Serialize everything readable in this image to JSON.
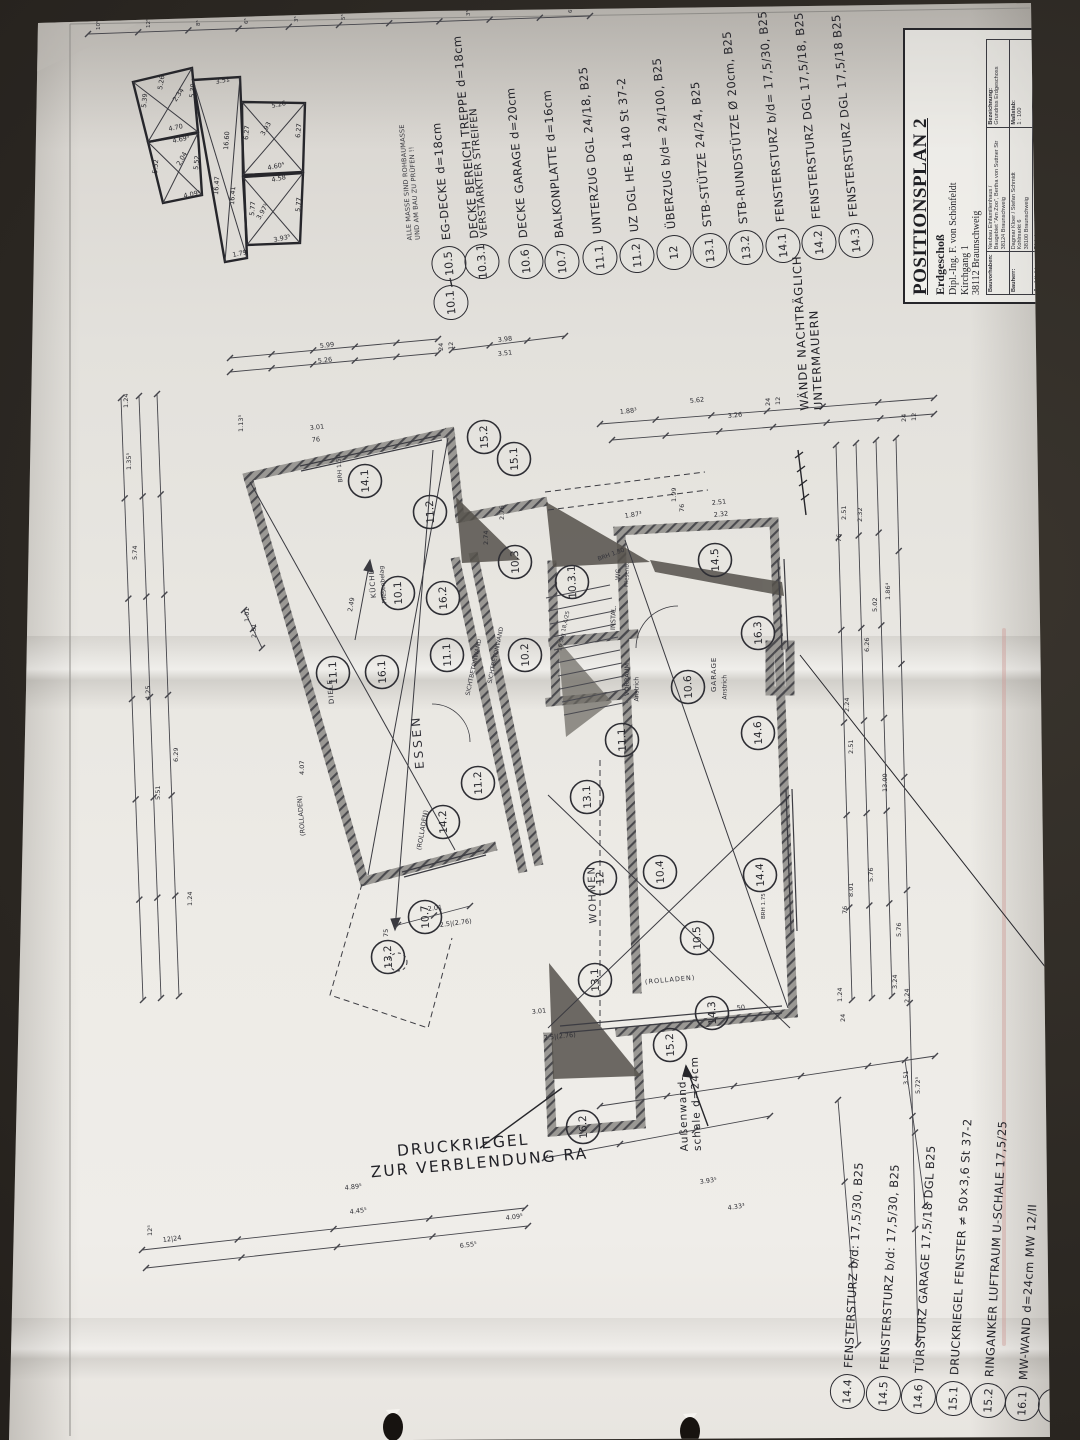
{
  "photo": {
    "background_color": "#2c2823",
    "paper_color": "#e9e7e2",
    "ink_color": "#2e2e34",
    "pencil_color": "#55514b",
    "crease_pink": "#cf9d98"
  },
  "sheet_note": {
    "line1": "ALLE MASSE SIND ROHBAUMASSE",
    "line2": "UND AM BAU ZU PRÜFEN !!"
  },
  "title_block": {
    "title": "POSITIONSPLAN 2",
    "subtitle": "Erdgeschoß",
    "client_line1": "Dipl.-Ing. F. von Schönfeldt",
    "client_line2": "Kirchgang 1",
    "client_line3": "38112 Braunschweig",
    "table": {
      "rows": [
        {
          "label": "Bauvorhaben:",
          "value": "Neubau Einfamilienhaus /\nBaugebiet \"Am Zoo\", Bertha von Suttner Str\n38124 Braunschweig"
        },
        {
          "label": "Bauherr:",
          "value": "Dagmar Kloer / Stefan Schmidt\nKohlmarkt 6\n38100 Braunschweig"
        },
        {
          "label": "Architekt:",
          "value": "Dipl.-Ing. - Architekt AKN Dietrich Bahr\nSpitzwegstraße 14\n38106 Braunschweig"
        }
      ],
      "right_rows": [
        {
          "label": "Bezeichnung:",
          "value": "Grundriss Erdgeschoss"
        },
        {
          "label": "Maßstab:",
          "value": "1 : 100"
        },
        {
          "label": "Zeichn.-Nr./Datum:",
          "value": "0424 - 5/08.08.04 - 0"
        }
      ]
    }
  },
  "legend_top": [
    {
      "id": "10.1",
      "text": ""
    },
    {
      "id": "10.5",
      "text": "EG-DECKE d=18cm"
    },
    {
      "id": "10.3.1",
      "text": "DECKE BEREICH TREPPE d=18cm",
      "text2": "VERSTÄRKTER STREIFEN"
    },
    {
      "id": "10.6",
      "text": "DECKE GARAGE d=20cm"
    },
    {
      "id": "10.7",
      "text": "BALKONPLATTE d=16cm"
    },
    {
      "id": "11.1",
      "text": "UNTERZUG DGL 24/18, B25"
    },
    {
      "id": "11.2",
      "text": "UZ DGL HE-B 140 St 37-2"
    },
    {
      "id": "12",
      "text": "ÜBERZUG b/d= 24/100, B25"
    },
    {
      "id": "13.1",
      "text": "STB-STÜTZE 24/24, B25"
    },
    {
      "id": "13.2",
      "text": "STB-RUNDSTÜTZE Ø 20cm, B25"
    },
    {
      "id": "14.1",
      "text": "FENSTERSTURZ b/d= 17,5/30, B25"
    },
    {
      "id": "14.2",
      "text": "FENSTERSTURZ DGL 17,5/18, B25"
    },
    {
      "id": "14.3",
      "text": "FENSTERSTURZ DGL 17,5/18 B25"
    }
  ],
  "legend_bottom": [
    {
      "id": "14.4",
      "text": "FENSTERSTURZ b/d: 17,5/30, B25"
    },
    {
      "id": "14.5",
      "text": "FENSTERSTURZ b/d: 17,5/30, B25"
    },
    {
      "id": "14.6",
      "text": "TÜRSTURZ GARAGE 17,5/18 DGL B25"
    },
    {
      "id": "15.1",
      "text": "DRUCKRIEGEL FENSTER ≠ 50×3,6 St 37-2"
    },
    {
      "id": "15.2",
      "text": "RINGANKER LUFTRAUM U-SCHALE 17,5/25"
    },
    {
      "id": "16.1",
      "text": "MW-WAND d=24cm   MW 12/II"
    },
    {
      "id": "16.2",
      "text": "STB-WAND d=24cm, B25"
    }
  ],
  "legend_side": {
    "id": "16.3",
    "text": "MW-KAMINWAND d=17,5cm   MW 12/II"
  },
  "plan": {
    "labels": [
      {
        "t": "ESSEN",
        "x": 420,
        "y": 762,
        "r": -95,
        "s": 12,
        "ls": 3
      },
      {
        "t": "WOHNEN",
        "x": 594,
        "y": 918,
        "r": -92,
        "s": 10,
        "ls": 2
      },
      {
        "t": "KÜCHE",
        "x": 374,
        "y": 594,
        "r": -95,
        "s": 7,
        "ls": 1
      },
      {
        "t": "Fliesenbelag",
        "x": 385,
        "y": 600,
        "r": -95,
        "s": 6,
        "ls": 0
      },
      {
        "t": "GARAGE",
        "x": 714,
        "y": 688,
        "r": -90,
        "s": 7,
        "ls": 1
      },
      {
        "t": "Anstrich",
        "x": 725,
        "y": 696,
        "r": -90,
        "s": 6,
        "ls": 0
      },
      {
        "t": "VORRAUM",
        "x": 627,
        "y": 692,
        "r": -90,
        "s": 6.5,
        "ls": 0
      },
      {
        "t": "Anstrich",
        "x": 637,
        "y": 698,
        "r": -90,
        "s": 6,
        "ls": 0
      },
      {
        "t": "WC",
        "x": 618,
        "y": 576,
        "r": -88,
        "s": 6.5,
        "ls": 0
      },
      {
        "t": "Fliesenb.",
        "x": 627,
        "y": 584,
        "r": -88,
        "s": 5.5,
        "ls": 0
      },
      {
        "t": "INSTAL.",
        "x": 613,
        "y": 626,
        "r": -88,
        "s": 6.5,
        "ls": 0
      },
      {
        "t": "DIELE",
        "x": 332,
        "y": 700,
        "r": -95,
        "s": 7,
        "ls": 1
      },
      {
        "t": "(ROLLADEN)",
        "x": 303,
        "y": 832,
        "r": -95,
        "s": 6.5,
        "ls": 0
      },
      {
        "t": "(ROLLADEN)",
        "x": 419,
        "y": 846,
        "r": -80,
        "s": 6.5,
        "ls": 0
      },
      {
        "t": "(ROLLADEN)",
        "x": 645,
        "y": 978,
        "r": -5,
        "s": 6.5,
        "ls": 1
      },
      {
        "t": "SICHTBETONWAND",
        "x": 468,
        "y": 692,
        "r": -78,
        "s": 6,
        "ls": 0
      },
      {
        "t": "SICHTBETONWAND",
        "x": 490,
        "y": 680,
        "r": -78,
        "s": 6,
        "ls": 0
      },
      {
        "t": "BRH 1.50",
        "x": 341,
        "y": 479,
        "r": -95,
        "s": 6,
        "ls": 0
      },
      {
        "t": "BRH 1.50",
        "x": 598,
        "y": 556,
        "r": -20,
        "s": 6,
        "ls": 0
      },
      {
        "t": "BRH 1.75",
        "x": 764,
        "y": 916,
        "r": -90,
        "s": 5.5,
        "ls": 0
      },
      {
        "t": "16 Stg 18,4/25",
        "x": 560,
        "y": 648,
        "r": -78,
        "s": 5.5,
        "ls": 0
      }
    ],
    "markers": [
      {
        "id": "14.1",
        "x": 365,
        "y": 481
      },
      {
        "id": "15.2",
        "x": 484,
        "y": 437
      },
      {
        "id": "15.1",
        "x": 514,
        "y": 459
      },
      {
        "id": "11.2",
        "x": 430,
        "y": 512
      },
      {
        "id": "10.1",
        "x": 398,
        "y": 593
      },
      {
        "id": "16.2",
        "x": 443,
        "y": 598
      },
      {
        "id": "10.3",
        "x": 515,
        "y": 562
      },
      {
        "id": "10.3.1",
        "x": 572,
        "y": 582
      },
      {
        "id": "10.2",
        "x": 525,
        "y": 655
      },
      {
        "id": "14.5",
        "x": 715,
        "y": 560
      },
      {
        "id": "16.3",
        "x": 758,
        "y": 633
      },
      {
        "id": "10.6",
        "x": 688,
        "y": 687
      },
      {
        "id": "14.6",
        "x": 758,
        "y": 733
      },
      {
        "id": "11.1",
        "x": 622,
        "y": 740
      },
      {
        "id": "11.1",
        "x": 333,
        "y": 673
      },
      {
        "id": "16.1",
        "x": 382,
        "y": 672
      },
      {
        "id": "11.1",
        "x": 447,
        "y": 655
      },
      {
        "id": "11.2",
        "x": 478,
        "y": 783
      },
      {
        "id": "14.2",
        "x": 443,
        "y": 822
      },
      {
        "id": "10.7",
        "x": 425,
        "y": 917
      },
      {
        "id": "13.2",
        "x": 388,
        "y": 957
      },
      {
        "id": "13.1",
        "x": 587,
        "y": 797
      },
      {
        "id": "12",
        "x": 600,
        "y": 878
      },
      {
        "id": "10.4",
        "x": 660,
        "y": 872
      },
      {
        "id": "14.4",
        "x": 760,
        "y": 875
      },
      {
        "id": "10.5",
        "x": 697,
        "y": 938
      },
      {
        "id": "13.1",
        "x": 595,
        "y": 980
      },
      {
        "id": "14.3",
        "x": 712,
        "y": 1013
      },
      {
        "id": "15.2",
        "x": 670,
        "y": 1045
      },
      {
        "id": "16.2",
        "x": 583,
        "y": 1127
      }
    ],
    "notes": {
      "walls_line1": "WÄNDE NACHTRÄGLICH",
      "walls_line2": "UNTERMAUERN",
      "outer_line1": "Außenwand-",
      "outer_line2": "schale d=24cm",
      "pressure_line1": "DRUCKRIEGEL",
      "pressure_line2": "ZUR VERBLENDUNG RA"
    }
  },
  "dimensions": [
    {
      "t": "10⁵",
      "x": 100,
      "y": 30,
      "r": -90,
      "s": 5.5
    },
    {
      "t": "12⁵",
      "x": 150,
      "y": 28,
      "r": -90,
      "s": 5.5
    },
    {
      "t": "8⁵",
      "x": 200,
      "y": 26,
      "r": -90,
      "s": 5.5
    },
    {
      "t": "6⁵",
      "x": 248,
      "y": 24,
      "r": -90,
      "s": 5.5
    },
    {
      "t": "3⁵",
      "x": 298,
      "y": 22,
      "r": -90,
      "s": 5.5
    },
    {
      "t": "5⁵",
      "x": 345,
      "y": 20,
      "r": -90,
      "s": 5.5
    },
    {
      "t": "3⁵",
      "x": 470,
      "y": 16,
      "r": -90,
      "s": 5.5
    },
    {
      "t": "6⁵",
      "x": 572,
      "y": 13,
      "r": -90,
      "s": 5.5
    },
    {
      "t": "5.99",
      "x": 320,
      "y": 348,
      "r": -6
    },
    {
      "t": "5.26",
      "x": 318,
      "y": 363,
      "r": -6
    },
    {
      "t": "3.98",
      "x": 498,
      "y": 342,
      "r": -6
    },
    {
      "t": "3.51",
      "x": 498,
      "y": 356,
      "r": -6
    },
    {
      "t": "24",
      "x": 443,
      "y": 351,
      "r": -90
    },
    {
      "t": "12",
      "x": 453,
      "y": 350,
      "r": -90
    },
    {
      "t": "3.01",
      "x": 310,
      "y": 430,
      "r": -6
    },
    {
      "t": "76",
      "x": 312,
      "y": 442,
      "r": -6
    },
    {
      "t": "1.13⁵",
      "x": 243,
      "y": 432,
      "r": -90
    },
    {
      "t": "1.88³",
      "x": 620,
      "y": 414,
      "r": -6
    },
    {
      "t": "5.62",
      "x": 690,
      "y": 403,
      "r": -6
    },
    {
      "t": "3.26",
      "x": 728,
      "y": 418,
      "r": -6
    },
    {
      "t": "24",
      "x": 770,
      "y": 406,
      "r": -90
    },
    {
      "t": "12",
      "x": 780,
      "y": 405,
      "r": -90
    },
    {
      "t": "2.51",
      "x": 712,
      "y": 505,
      "r": -6
    },
    {
      "t": "2.32",
      "x": 714,
      "y": 517,
      "r": -6
    },
    {
      "t": "76",
      "x": 684,
      "y": 512,
      "r": -90
    },
    {
      "t": "1.99",
      "x": 676,
      "y": 502,
      "r": -90
    },
    {
      "t": "1.24",
      "x": 128,
      "y": 408,
      "r": -90
    },
    {
      "t": "1.35⁵",
      "x": 131,
      "y": 470,
      "r": -90
    },
    {
      "t": "5.74",
      "x": 137,
      "y": 560,
      "r": -90
    },
    {
      "t": "4.25",
      "x": 150,
      "y": 700,
      "r": -90
    },
    {
      "t": "5.51",
      "x": 160,
      "y": 800,
      "r": -90
    },
    {
      "t": "6.29",
      "x": 178,
      "y": 762,
      "r": -90
    },
    {
      "t": "1.01",
      "x": 249,
      "y": 622,
      "r": -90
    },
    {
      "t": "2.51",
      "x": 256,
      "y": 638,
      "r": -90
    },
    {
      "t": "4.07",
      "x": 304,
      "y": 775,
      "r": -90
    },
    {
      "t": "1.24",
      "x": 192,
      "y": 906,
      "r": -90
    },
    {
      "t": "75",
      "x": 388,
      "y": 937,
      "r": -90
    },
    {
      "t": "2.01",
      "x": 428,
      "y": 911,
      "r": -7
    },
    {
      "t": "2.5|(2.76)",
      "x": 440,
      "y": 927,
      "r": -7
    },
    {
      "t": "12⁵",
      "x": 152,
      "y": 1236,
      "r": -90
    },
    {
      "t": "2.51",
      "x": 846,
      "y": 520,
      "r": -90
    },
    {
      "t": "2.32",
      "x": 862,
      "y": 522,
      "r": -90
    },
    {
      "t": "76",
      "x": 841,
      "y": 542,
      "r": -90
    },
    {
      "t": "5.02",
      "x": 877,
      "y": 612,
      "r": -90
    },
    {
      "t": "6.26",
      "x": 869,
      "y": 652,
      "r": -90
    },
    {
      "t": "2.24",
      "x": 849,
      "y": 712,
      "r": -90
    },
    {
      "t": "2.51",
      "x": 853,
      "y": 754,
      "r": -90
    },
    {
      "t": "13.00",
      "x": 887,
      "y": 792,
      "r": -90
    },
    {
      "t": "5.76",
      "x": 873,
      "y": 882,
      "r": -90
    },
    {
      "t": "8.01",
      "x": 853,
      "y": 897,
      "r": -90
    },
    {
      "t": "76",
      "x": 847,
      "y": 914,
      "r": -90
    },
    {
      "t": "5.76",
      "x": 901,
      "y": 937,
      "r": -90
    },
    {
      "t": "3.24",
      "x": 897,
      "y": 989,
      "r": -90
    },
    {
      "t": "2.24",
      "x": 909,
      "y": 1003,
      "r": -90
    },
    {
      "t": "1.86⁴",
      "x": 890,
      "y": 600,
      "r": -90
    },
    {
      "t": "24",
      "x": 906,
      "y": 422,
      "r": -90
    },
    {
      "t": "12",
      "x": 916,
      "y": 421,
      "r": -90
    },
    {
      "t": "3.51",
      "x": 908,
      "y": 1085,
      "r": -90
    },
    {
      "t": "5.72⁵",
      "x": 920,
      "y": 1094,
      "r": -90
    },
    {
      "t": "1.24",
      "x": 842,
      "y": 1002,
      "r": -90
    },
    {
      "t": "24",
      "x": 845,
      "y": 1022,
      "r": -90
    },
    {
      "t": "4.89⁵",
      "x": 345,
      "y": 1190,
      "r": -7
    },
    {
      "t": "4.45⁵",
      "x": 350,
      "y": 1214,
      "r": -7
    },
    {
      "t": "12|24",
      "x": 163,
      "y": 1242,
      "r": -7
    },
    {
      "t": "4.09⁵",
      "x": 506,
      "y": 1220,
      "r": -7
    },
    {
      "t": "6.55⁵",
      "x": 460,
      "y": 1248,
      "r": -7
    },
    {
      "t": "3.93⁵",
      "x": 700,
      "y": 1184,
      "r": -8
    },
    {
      "t": "4.33³",
      "x": 728,
      "y": 1210,
      "r": -8
    },
    {
      "t": "3.01",
      "x": 532,
      "y": 1014,
      "r": -6
    },
    {
      "t": "2.5|(2.76)",
      "x": 544,
      "y": 1040,
      "r": -6
    },
    {
      "t": "50",
      "x": 737,
      "y": 1010,
      "r": -6
    },
    {
      "t": "2.49",
      "x": 352,
      "y": 612,
      "r": -80
    },
    {
      "t": "2.76",
      "x": 504,
      "y": 520,
      "r": -90
    },
    {
      "t": "1.87³",
      "x": 625,
      "y": 518,
      "r": -8
    },
    {
      "t": "2.74",
      "x": 488,
      "y": 545,
      "r": -90
    }
  ],
  "area_sketch": {
    "labels": [
      {
        "t": "5.26",
        "x": 162,
        "y": 90,
        "r": -80
      },
      {
        "t": "2.34",
        "x": 176,
        "y": 102,
        "r": -55
      },
      {
        "t": "5.39",
        "x": 146,
        "y": 108,
        "r": -85
      },
      {
        "t": "5.39",
        "x": 194,
        "y": 98,
        "r": -85
      },
      {
        "t": "4.70",
        "x": 169,
        "y": 131,
        "r": -12
      },
      {
        "t": "4.69⁵",
        "x": 173,
        "y": 143,
        "r": -12
      },
      {
        "t": "2.04",
        "x": 180,
        "y": 166,
        "r": -60
      },
      {
        "t": "5.52",
        "x": 157,
        "y": 174,
        "r": -85
      },
      {
        "t": "5.52",
        "x": 198,
        "y": 170,
        "r": -85
      },
      {
        "t": "4.09⁵",
        "x": 184,
        "y": 198,
        "r": -12
      },
      {
        "t": "3.51",
        "x": 216,
        "y": 84,
        "r": -12
      },
      {
        "t": "16.60",
        "x": 228,
        "y": 150,
        "r": -86
      },
      {
        "t": "16.41",
        "x": 234,
        "y": 205,
        "r": -86
      },
      {
        "t": "16.47",
        "x": 218,
        "y": 195,
        "r": -86
      },
      {
        "t": "1.79",
        "x": 233,
        "y": 257,
        "r": -12
      },
      {
        "t": "5.26",
        "x": 272,
        "y": 108,
        "r": -12
      },
      {
        "t": "3.93",
        "x": 264,
        "y": 136,
        "r": -60
      },
      {
        "t": "6.27",
        "x": 248,
        "y": 140,
        "r": -85
      },
      {
        "t": "6.27",
        "x": 300,
        "y": 138,
        "r": -85
      },
      {
        "t": "4.60⁴",
        "x": 268,
        "y": 170,
        "r": -12
      },
      {
        "t": "4.58",
        "x": 272,
        "y": 182,
        "r": -12
      },
      {
        "t": "3.97⁵",
        "x": 260,
        "y": 220,
        "r": -60
      },
      {
        "t": "5.77",
        "x": 254,
        "y": 216,
        "r": -85
      },
      {
        "t": "5.77",
        "x": 300,
        "y": 212,
        "r": -85
      },
      {
        "t": "3.93⁵",
        "x": 274,
        "y": 242,
        "r": -12
      }
    ]
  }
}
